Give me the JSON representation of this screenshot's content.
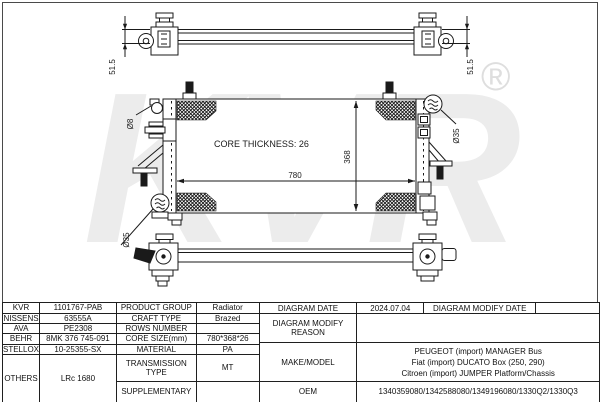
{
  "drawing": {
    "watermark": "KVR",
    "registered_mark": "®",
    "core_thickness_label": "CORE THICKNESS: 26",
    "dim_width": "780",
    "dim_height": "368",
    "dim_depth_left": "51.5",
    "dim_depth_right": "51.5",
    "label_dia8": "Ø8",
    "label_dia35_right": "Ø35",
    "label_dia35_bottom": "Ø35",
    "line_color": "#1a1a1a",
    "watermark_color": "#ececec"
  },
  "table": {
    "rows": [
      {
        "brand": "KVR",
        "number": "1101767-PAB",
        "label": "PRODUCT GROUP",
        "value": "Radiator"
      },
      {
        "brand": "NISSENS",
        "number": "63555A",
        "label": "CRAFT TYPE",
        "value": "Brazed"
      },
      {
        "brand": "AVA",
        "number": "PE2308",
        "label": "ROWS NUMBER",
        "value": ""
      },
      {
        "brand": "BEHR",
        "number": "8MK 376 745-091",
        "label": "CORE SIZE(mm)",
        "value": "780*368*26"
      },
      {
        "brand": "STELLOX",
        "number": "10-25355-SX",
        "label": "MATERIAL",
        "value": "PA"
      },
      {
        "brand": "OTHERS",
        "number": "LRc 1680",
        "label": "TRANSMISSION TYPE",
        "value": "MT"
      },
      {
        "label": "SUPPLEMENTARY",
        "value": ""
      }
    ],
    "right": {
      "diagram_date_label": "DIAGRAM DATE",
      "diagram_date_value": "2024.07.04",
      "diagram_modify_date_label": "DIAGRAM MODIFY DATE",
      "diagram_modify_date_value": "",
      "diagram_modify_reason_label": "DIAGRAM MODIFY REASON",
      "diagram_modify_reason_value": "",
      "make_model_label": "MAKE/MODEL",
      "make_model_lines": [
        "PEUGEOT (import) MANAGER Bus",
        "Fiat (import) DUCATO Box (250, 290)",
        "Citroen (import) JUMPER Platform/Chassis"
      ],
      "oem_label": "OEM",
      "oem_value": "1340359080/1342588080/1349196080/1330Q2/1330Q3"
    }
  }
}
